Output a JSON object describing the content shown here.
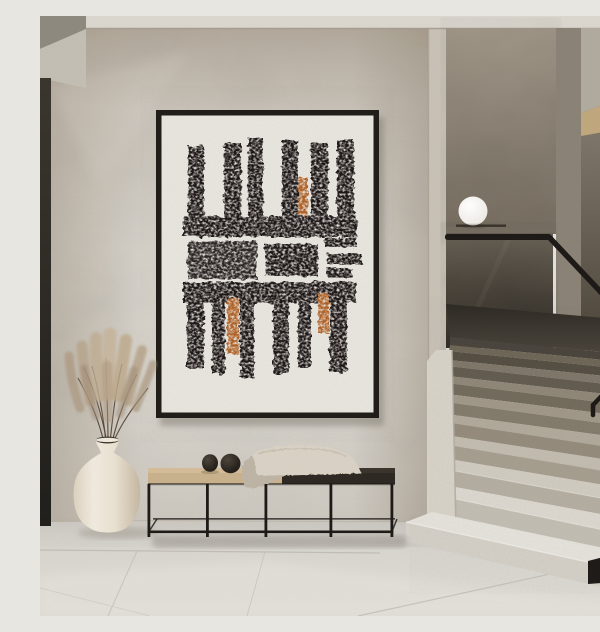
{
  "scene": {
    "description": "Minimalist hallway interior: framed abstract block-print art on plaster wall, metal-frame bench with folded blanket and two black decor spheres, cream vase with dried pampas grass, terrazzo staircase with smoked-glass balustrade, black handrail and white globe lamp",
    "objects": [
      "abstract-artwork",
      "bench",
      "blanket",
      "decor-spheres",
      "vase",
      "pampas-grass",
      "staircase",
      "glass-balustrade",
      "handrail",
      "sphere-lamp",
      "tiled-floor"
    ]
  },
  "palette": {
    "ink": "#1b1713",
    "rust": "#b06227",
    "matte": "#e9e6df",
    "frame": "#211e1a",
    "metal": "#1d1a17",
    "oak": "#d5bd99",
    "oakface": "#c9b28d",
    "benchdark": "#3a342c",
    "benchface": "#2e2922",
    "blanket": "#d9d2c5",
    "vase": "#ece4d6",
    "pampas": "#b7a288",
    "stems": "#554536",
    "lamp": "#f4f2ee",
    "sphere": "#242019",
    "skirting": "#1e1b18",
    "floor": "#d9d6d0",
    "wall": "#d3cec5"
  },
  "artwork": {
    "top_stripes": [
      {
        "x": 148,
        "y": 130,
        "w": 16,
        "h": 72
      },
      {
        "x": 184,
        "y": 127,
        "w": 17,
        "h": 75
      },
      {
        "x": 208,
        "y": 122,
        "w": 15,
        "h": 80
      },
      {
        "x": 242,
        "y": 124,
        "w": 16,
        "h": 78
      },
      {
        "x": 258,
        "y": 162,
        "w": 10,
        "h": 40,
        "accent": true
      },
      {
        "x": 271,
        "y": 127,
        "w": 17,
        "h": 75
      },
      {
        "x": 297,
        "y": 124,
        "w": 17,
        "h": 78
      }
    ],
    "bands": [
      {
        "x": 143,
        "y": 200,
        "w": 174,
        "h": 21
      },
      {
        "x": 143,
        "y": 266,
        "w": 170,
        "h": 21
      }
    ],
    "band_chunks": [
      {
        "x": 172,
        "y": 266,
        "w": 30,
        "h": 21,
        "o": 0.9
      },
      {
        "x": 276,
        "y": 266,
        "w": 40,
        "h": 21,
        "o": 0.9
      }
    ],
    "blocks": [
      {
        "x": 148,
        "y": 225,
        "w": 69,
        "h": 38,
        "o": 0.93
      },
      {
        "x": 225,
        "y": 228,
        "w": 53,
        "h": 32
      }
    ],
    "side_bars": [
      {
        "x": 285,
        "y": 222,
        "w": 32,
        "h": 9
      },
      {
        "x": 287,
        "y": 238,
        "w": 35,
        "h": 10
      },
      {
        "x": 287,
        "y": 252,
        "w": 25,
        "h": 9
      }
    ],
    "bottom_stripes": [
      {
        "x": 147,
        "y": 287,
        "w": 17,
        "h": 65
      },
      {
        "x": 172,
        "y": 287,
        "w": 13,
        "h": 71
      },
      {
        "x": 187,
        "y": 282,
        "w": 12,
        "h": 56,
        "accent": true
      },
      {
        "x": 200,
        "y": 287,
        "w": 14,
        "h": 75
      },
      {
        "x": 233,
        "y": 287,
        "w": 16,
        "h": 71
      },
      {
        "x": 258,
        "y": 287,
        "w": 13,
        "h": 65
      },
      {
        "x": 278,
        "y": 277,
        "w": 11,
        "h": 40,
        "accent": true
      },
      {
        "x": 290,
        "y": 287,
        "w": 17,
        "h": 70
      }
    ]
  }
}
